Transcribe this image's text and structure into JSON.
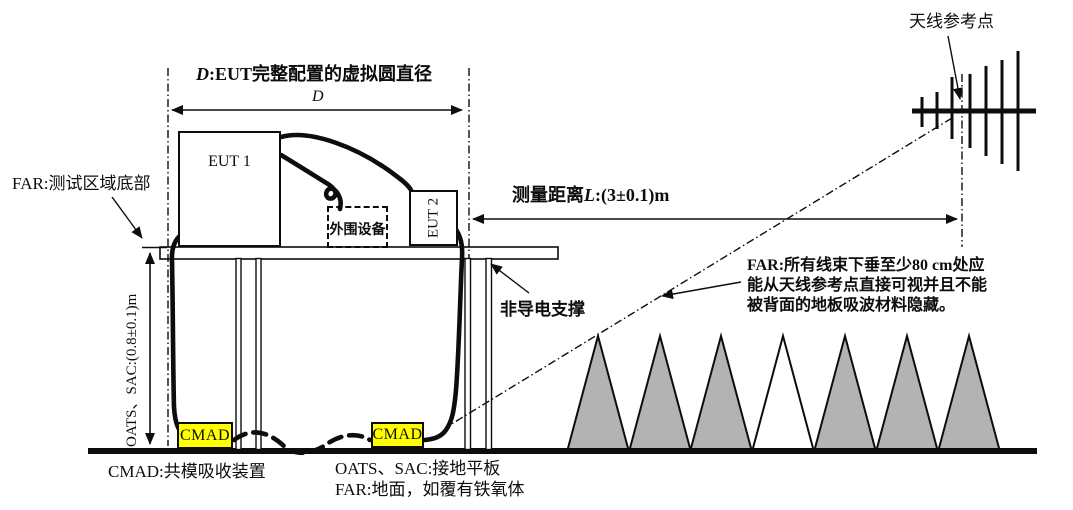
{
  "labels": {
    "antenna_ref": "天线参考点",
    "d_var": "D",
    "d_title_rest": ":EUT完整配置的虚拟圆直径",
    "d_dim": "D",
    "far_test_area": "FAR:测试区域底部",
    "measure_prefix": "测量距离",
    "measure_var": "L",
    "measure_suffix": ":(3±0.1)m",
    "far_note_line1": "FAR:所有线束下垂至少80 cm处应",
    "far_note_line2": "能从天线参考点直接可视并且不能",
    "far_note_line3": "被背面的地板吸波材料隐藏。",
    "non_conductive_support": "非导电支撑",
    "oats_sac_height": "OATS、SAC:(0.8±0.1)m",
    "eut1": "EUT 1",
    "eut2": "EUT 2",
    "peripheral": "外围设备",
    "cmad1": "CMAD",
    "cmad2": "CMAD",
    "caption_cmad": "CMAD:共模吸收装置",
    "caption_oats": "OATS、SAC:接地平板",
    "caption_far_ground": "FAR:地面，如覆有铁氧体"
  },
  "colors": {
    "line": "#0d0d0d",
    "cmad_fill": "#ffff00",
    "cone_fill": "#b3b3b3",
    "background": "#ffffff"
  }
}
